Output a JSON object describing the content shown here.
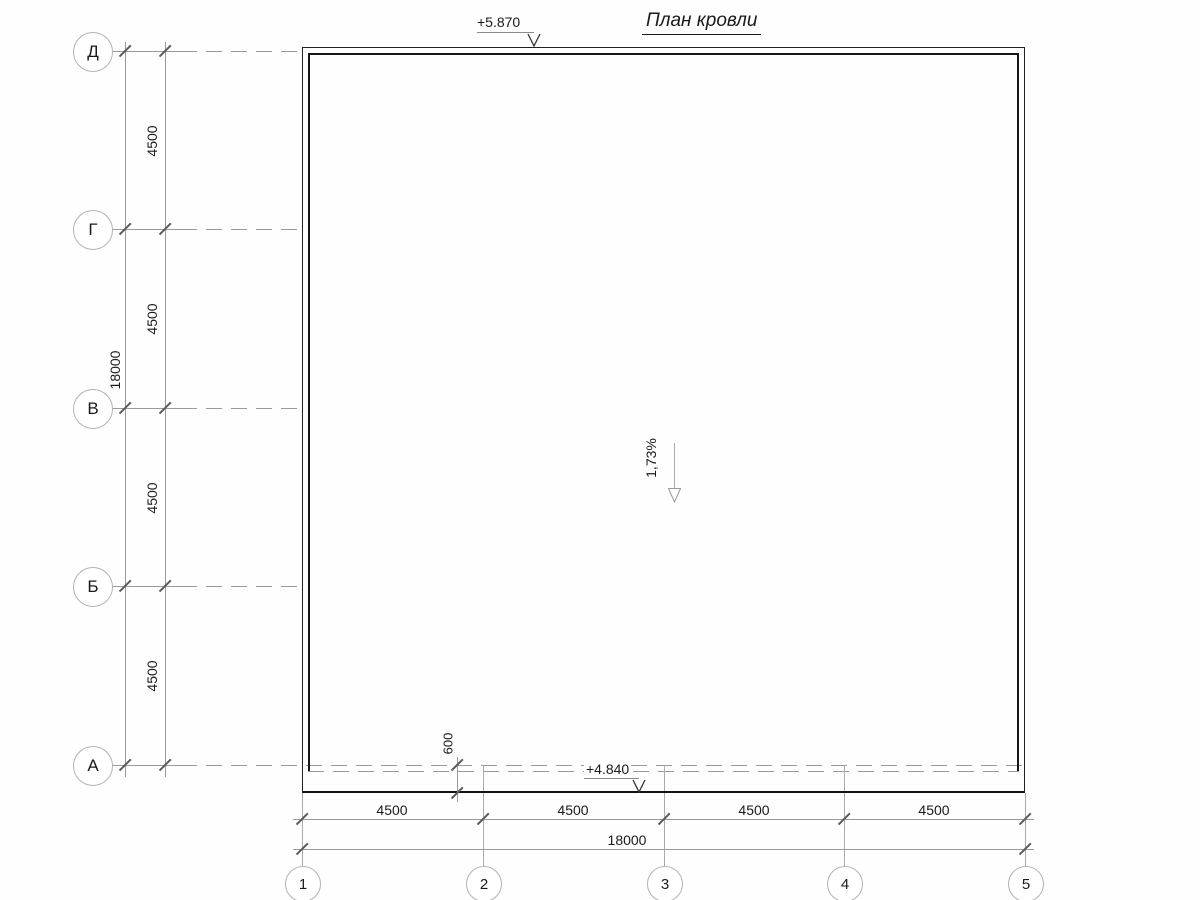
{
  "title": "План кровли",
  "annotations": {
    "elevation_top": "+5.870",
    "elevation_bottom": "+4.840",
    "slope": "1,73%",
    "overhang": "600"
  },
  "axes": {
    "rows": [
      {
        "label": "Д"
      },
      {
        "label": "Г"
      },
      {
        "label": "В"
      },
      {
        "label": "Б"
      },
      {
        "label": "А"
      }
    ],
    "cols": [
      {
        "label": "1"
      },
      {
        "label": "2"
      },
      {
        "label": "3"
      },
      {
        "label": "4"
      },
      {
        "label": "5"
      }
    ]
  },
  "dimensions": {
    "row_spans": [
      "4500",
      "4500",
      "4500",
      "4500"
    ],
    "row_total": "18000",
    "col_spans": [
      "4500",
      "4500",
      "4500",
      "4500"
    ],
    "col_total": "18000"
  }
}
